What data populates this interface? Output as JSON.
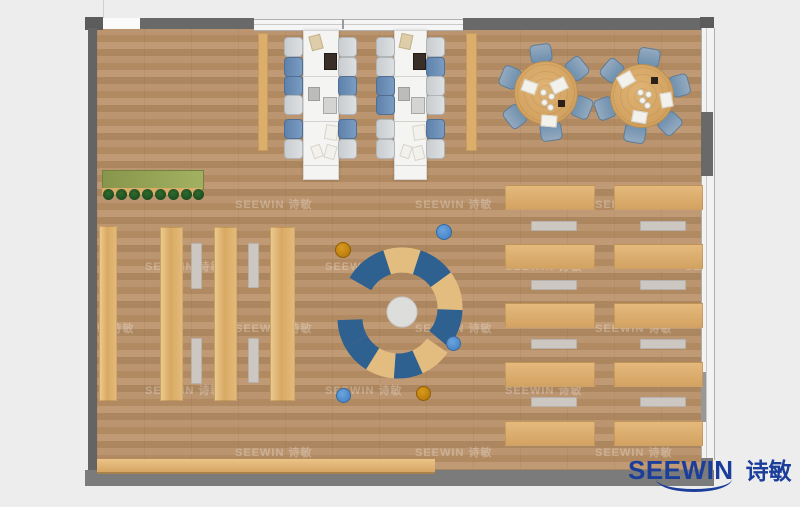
{
  "logo": {
    "brand": "SEEWIN",
    "brand_cn": "诗敏",
    "color": "#1c3e9b"
  },
  "watermark": {
    "text": "SEEWIN 诗敏"
  },
  "palette": {
    "outside_background": "#ededed",
    "floor_wood": "#b5906a",
    "wall_gray": "#696969",
    "furniture_wood": "#ddb173",
    "workstation_white": "#f4f4f3",
    "chair_blue": "#6f94bd",
    "chair_gray": "#d3d6d8",
    "round_table_chair_blue": "#7f9cb6",
    "arc_bench_blue": "#2e6090",
    "arc_bench_wood": "#e3bc7f",
    "stool_blue": "#4a86c8",
    "stool_amber": "#c8860a",
    "planter_green": "#93a254",
    "bench_gray": "#ccc7c1"
  },
  "inventory": {
    "workstation_benches": 2,
    "chairs_per_workstation": 12,
    "round_tables": 2,
    "chairs_per_round_table": 6,
    "bookshelf_columns": 4,
    "reading_desk_rows": 10,
    "curved_bench_arcs": 2,
    "round_stools": 5,
    "plants": 8
  }
}
